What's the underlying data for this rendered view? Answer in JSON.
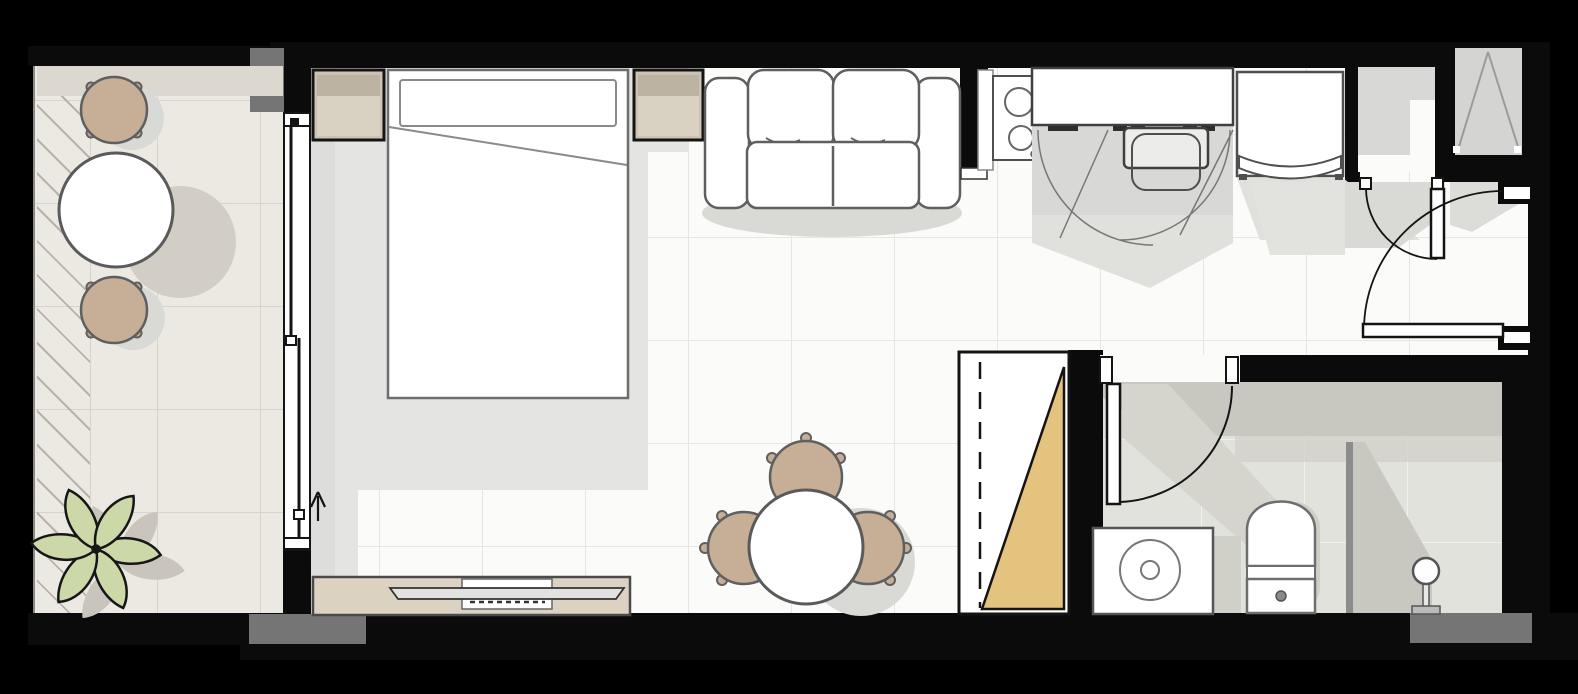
{
  "plan": {
    "title": "studio-apartment-floor-plan",
    "rooms": [
      {
        "id": "balcony",
        "items": [
          "bistro-chair",
          "bistro-chair",
          "round-bistro-table",
          "potted-plant",
          "tiled-deck"
        ]
      },
      {
        "id": "bedroom-living",
        "items": [
          "double-bed",
          "pillow",
          "nightstand-left",
          "nightstand-right",
          "sliding-glass-door",
          "sofa",
          "tv-console",
          "tv",
          "media-box",
          "dining-table",
          "dining-chair",
          "dining-chair",
          "dining-chair",
          "area-rug",
          "entrance-arrow"
        ]
      },
      {
        "id": "kitchen",
        "items": [
          "cooktop-2-burner",
          "counter",
          "sink",
          "base-cabinets",
          "refrigerator"
        ]
      },
      {
        "id": "entry",
        "items": [
          "coat-closet",
          "closet-door",
          "entry-door",
          "duct-shaft"
        ]
      },
      {
        "id": "bathroom",
        "items": [
          "bathroom-door",
          "washing-machine",
          "toilet",
          "shower-screen",
          "shower-head",
          "wardrobe-sliding"
        ]
      }
    ],
    "labels": {
      "balcony": "balcony",
      "bistroTable": "round-bistro-table",
      "bistroChairTop": "bistro-chair",
      "bistroChairBottom": "bistro-chair",
      "plant": "potted-plant",
      "slidingDoor": "sliding-glass-door",
      "arrow": "entrance-arrow",
      "rug": "area-rug",
      "bed": "double-bed",
      "pillow": "pillow",
      "nightstandLeft": "nightstand",
      "nightstandRight": "nightstand",
      "sofa": "sofa",
      "console": "tv-console",
      "tv": "flat-screen-tv",
      "mediaBox": "media-box",
      "diningTable": "dining-table",
      "diningChair": "dining-chair",
      "cooktop": "cooktop",
      "counter": "kitchen-counter",
      "sink": "kitchen-sink",
      "fridge": "refrigerator",
      "wardrobe": "sliding-wardrobe",
      "bathDoor": "bathroom-door",
      "washer": "washing-machine",
      "toilet": "toilet",
      "screen": "shower-glass-screen",
      "shower": "shower-head",
      "closet": "coat-closet",
      "closetDoor": "closet-door",
      "entryDoor": "entry-door",
      "shaft": "duct-shaft"
    },
    "colors": {
      "bg": "#000000",
      "wall": "#0b0b0b",
      "grayBlock": "#757575",
      "balconyFloor": "#ece9e2",
      "balconyLine": "#d7d3ca",
      "balconyShadowBand": "#dcd8d0",
      "hatchLine": "#b7b3aa",
      "floor": "#fbfbfa",
      "floorLine": "#e6e6e3",
      "rug": "#e4e4e2",
      "rugEdge": "#d9d9d7",
      "shadow": "#d9d9d6",
      "bathFloor": "#e2e2dc",
      "bathLine": "#f0f0ec",
      "bathShadow": "#c8c8c1",
      "white": "#ffffff",
      "chairTan": "#c6ae97",
      "nightstand": "#cdc3b2",
      "nightstandBand": "#bdb3a2",
      "nightstandLight": "#d9d1c2",
      "console": "#dcd2c2",
      "wardrobeTriangle": "#e3c37e",
      "plantFill": "#ccd8a7",
      "plantStroke": "#161616",
      "cabinetGray": "#d8d8d6",
      "glass": "#8c8c8c",
      "furnitureStroke": "#5f5f5f",
      "doorStroke": "#141414"
    }
  }
}
